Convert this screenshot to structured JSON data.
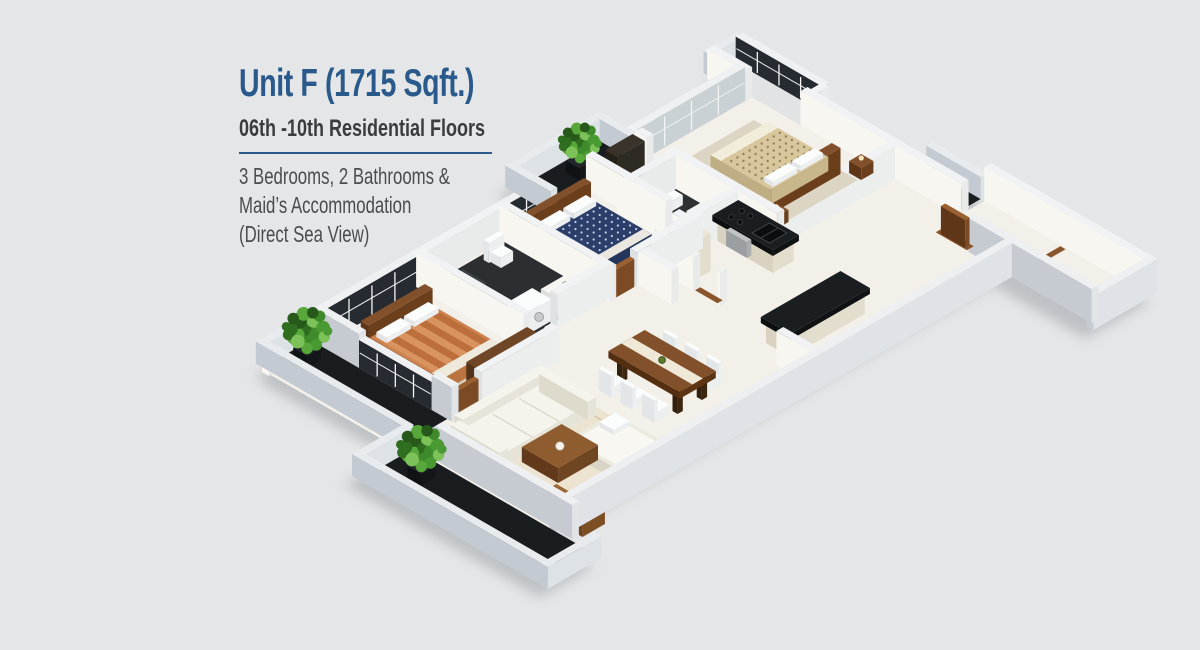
{
  "header": {
    "title": "Unit F (1715 Sqft.)",
    "subtitle": "06th -10th Residential Floors",
    "description_lines": [
      "3 Bedrooms, 2 Bathrooms &",
      "Maid’s Accommodation",
      "(Direct Sea View)"
    ]
  },
  "palette": {
    "background": "#e5e6e7",
    "accent_blue": "#2a598b",
    "subtitle_text": "#3b3c3e",
    "body_text": "#4b4c4e",
    "wall_top": "#eef0f2",
    "wall_shade": "#c6cbd1",
    "marble_floor": "#f3f0ea",
    "granite_dark": "#1a1d20",
    "glass_dark": "#252b30",
    "wood_brown": "#82502a",
    "bed_gold": "#d8c69c",
    "bed_navy": "#2c3f6b",
    "bed_orange": "#cd824f",
    "sofa_white": "#f4f3ec",
    "plant_green": "#3f8a2a"
  },
  "floorplan": {
    "view": "isometric-3d-render",
    "rooms": [
      "master-bedroom",
      "bedroom-2",
      "bedroom-3",
      "ensuite-bathroom",
      "common-bathroom",
      "kitchen",
      "breakfast-bar",
      "living-room",
      "dining-area",
      "maid-room",
      "entrance-corridor",
      "balconies"
    ]
  }
}
